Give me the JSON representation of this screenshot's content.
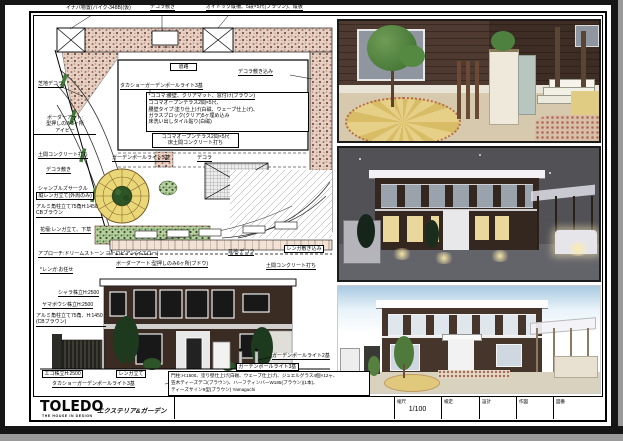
{
  "plan": {
    "shed": "イナバ物置(バイク-348B)(仮)",
    "decora_top": "デコラ敷き",
    "oitok": "オイトック縦柵、5段×5尺(ブラウン)、縦板",
    "road": "道路",
    "decora_right": "デコラ敷き込み",
    "lawn": "芝地デコラ",
    "border_art1": "ボーダーアート:",
    "border_art2": "型押しのみ3ヶ所",
    "border_art3": "アイビー",
    "doma_left": "土間コンクリート打ち",
    "decora_left": "デコラ敷き",
    "circle1": "シャンブルズサークル",
    "circle2": "縦レンガ立て(外周のみ)",
    "alumi1": "アルミ角柱立て75角H:1450",
    "alumi2": "CBブラウン",
    "flowerbed": "花壇:レンガ立て、下草",
    "approach": "アプローチ:ドリームストーン ヨーロピアン(イエロー)",
    "brick_note": "*レンガ:お任せ",
    "pole_light": "タカショーガーデンポールライト3基",
    "cocoma_note": "*ココマ:腰壁、クリアマット、窓付け(ブラウン)",
    "cocoma1": "ココマオープンテラス2間×5尺、",
    "cocoma2": "腰壁タイプ:塗り仕上げ(白磁、ウェーブ仕上げ)、",
    "cocoma3": "ガラスブロック(クリア)5ヶ埋め込み",
    "cocoma4": "床洗い出しタイル貼り(白磁)",
    "terrace1": "ココマオープンテラス2間×5尺",
    "terrace2": "床土間コンクリート打ち",
    "garden_pole": "ガーデンポールライト3基",
    "decora_mid": "デコラ",
    "border_art_b": "ボーダーアート:型押しのみ6ヶ所(ブドウ)",
    "joint": "目地:デコラ",
    "brick_paving": "レンガ敷き込み",
    "doma_bottom": "土間コンクリート打ち"
  },
  "elevation": {
    "shara": "シャラ株立H:2500",
    "yamaboushi": "ヤマボウシ株立H:2500",
    "alumi1": "アルミ角柱立て75角、H:1450",
    "alumi2": "(CBブラウン)",
    "ego": "エゴ株立H:2500",
    "renga": "レンガ立て",
    "takasho": "タカショーガーデンポールライト3基",
    "pole2": "ガーデンポールライト2基",
    "pole3": "ガーデンポールライト3基",
    "spec1": "門柱:H:1500、塗り壁仕上げ(白磁、ウェーブ仕上げ)、ジュエルグラス4個×12ヶ、",
    "spec2": "笠木ティーズデコ(ブラウン)、ハーフティンバーW185(ブラウン)(1本)、",
    "spec3": "ティーズサイン9型(ブラウン) Yamaguchi"
  },
  "title_block": {
    "logo": "TOLEDO",
    "tagline": "THE HOUSE IN DESIGN",
    "subtitle": "エクステリア&ガーデン",
    "fields": [
      {
        "label": "縮尺",
        "value": "1/100"
      },
      {
        "label": "検定",
        "value": ""
      },
      {
        "label": "設計",
        "value": ""
      },
      {
        "label": "作図",
        "value": ""
      },
      {
        "label": "図番",
        "value": ""
      }
    ]
  },
  "colors": {
    "aggregate_paving": "#c89a8a",
    "circle_paving": "#ead878",
    "planting_green": "#3f6e33",
    "house_brick": "#3a2b23",
    "night_sky": "#515156"
  }
}
